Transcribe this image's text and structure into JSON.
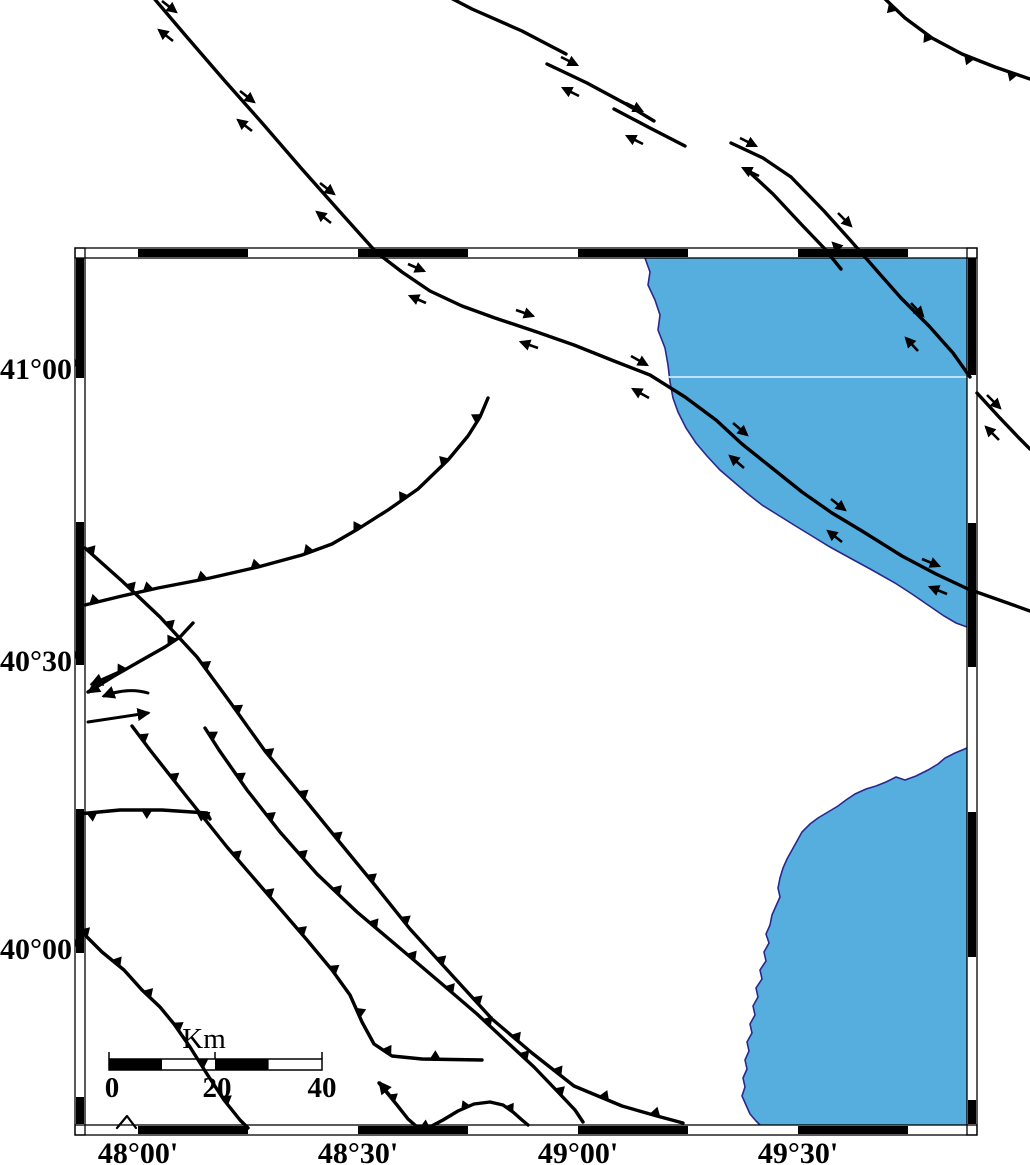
{
  "figure": {
    "type": "tectonic-fault-map",
    "region_note": "map with sea polygons, thrust faults (teeth) and strike-slip faults (paired half-arrows)"
  },
  "axis": {
    "lat": [
      "41°00'",
      "40°30'",
      "40°00'"
    ],
    "lon": [
      "48°00'",
      "48°30'",
      "49°00'",
      "49°30'"
    ]
  },
  "scalebar": {
    "unit": "Km",
    "ticks": [
      "0",
      "20",
      "40"
    ]
  },
  "colors": {
    "sea_fill": "#56aedf",
    "coast_outline": "#28288f",
    "fault": "#000000",
    "frame": "#000000",
    "background": "#ffffff",
    "sea_gridline": "#bfe2f5"
  }
}
